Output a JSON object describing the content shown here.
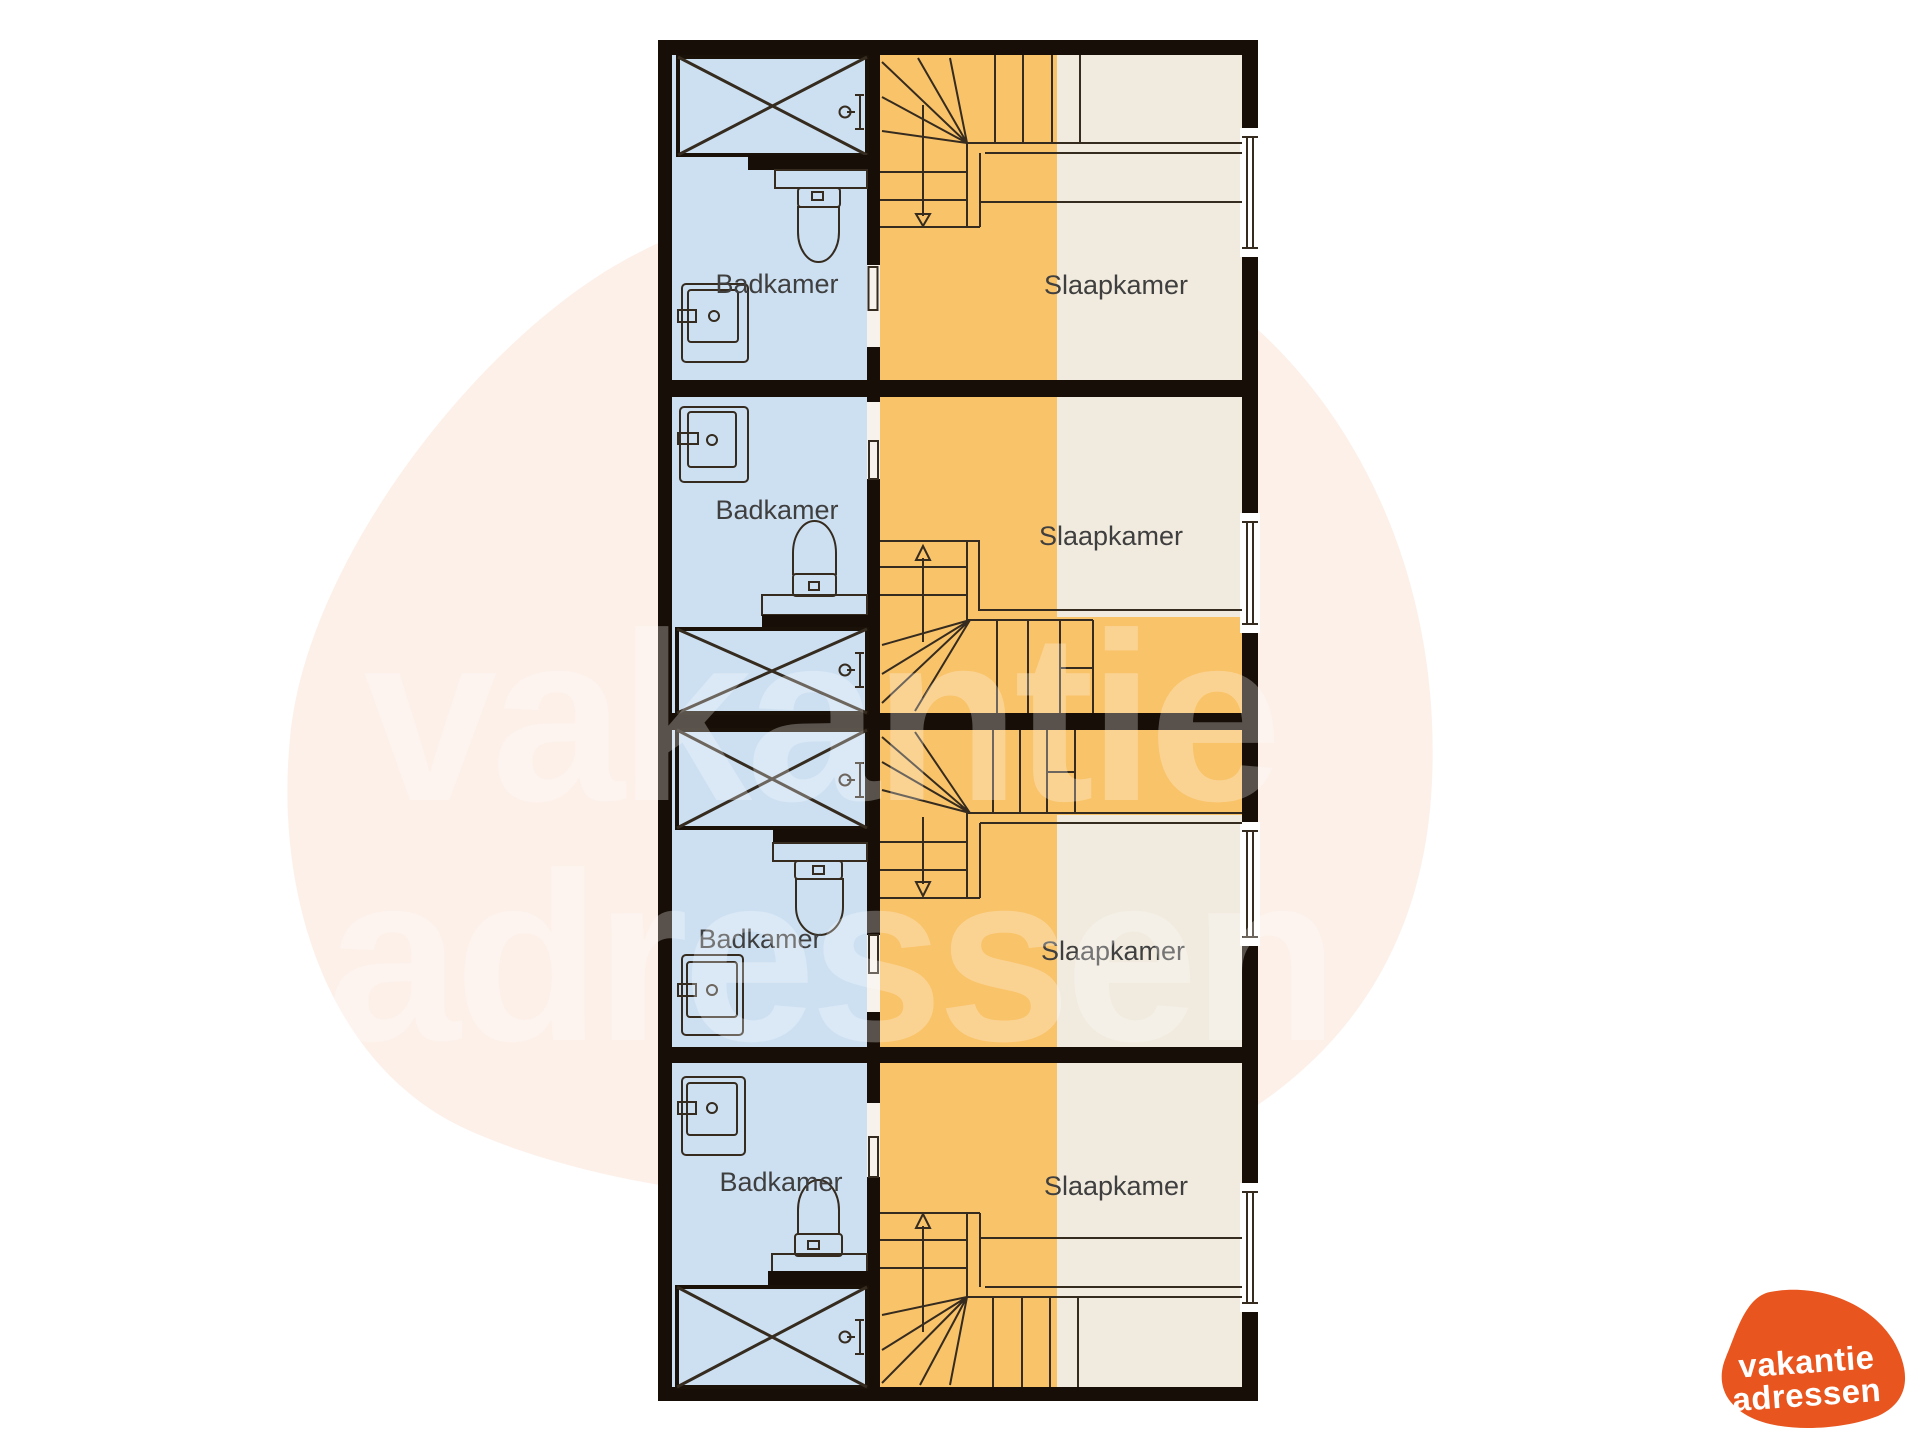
{
  "watermark": {
    "line1": "vakantie",
    "line2": "adressen"
  },
  "logo": {
    "line1": "vakantie",
    "line2": "adressen"
  },
  "units": [
    {
      "bathroom_label": "Badkamer",
      "bedroom_label": "Slaapkamer"
    },
    {
      "bathroom_label": "Badkamer",
      "bedroom_label": "Slaapkamer"
    },
    {
      "bathroom_label": "Badkamer",
      "bedroom_label": "Slaapkamer"
    },
    {
      "bathroom_label": "Badkamer",
      "bedroom_label": "Slaapkamer"
    }
  ],
  "colors": {
    "bathroom": "#cde0f2",
    "bedroom-orange": "#f9c36a",
    "bedroom-cream": "#f1ebdf",
    "wall": "#170e07",
    "line": "#352b1f",
    "blob": "#fdf0e9",
    "logo": "#e8551e"
  }
}
